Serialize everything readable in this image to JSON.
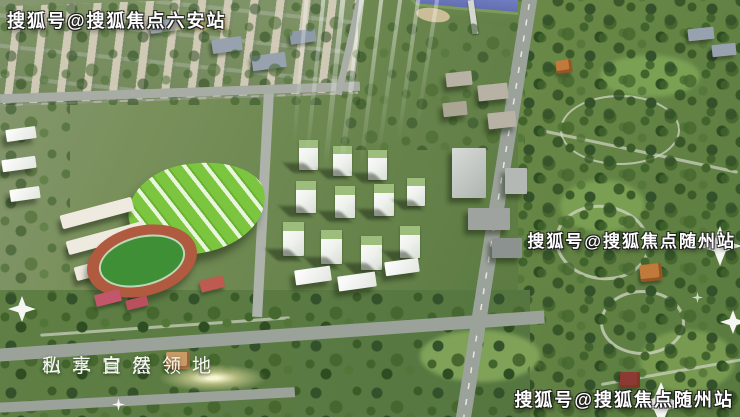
{
  "watermarks": {
    "top_left": "搜狐号@搜狐焦点六安站",
    "middle_right": "搜狐号@搜狐焦点随州站",
    "bottom_right": "搜狐号@搜狐焦点随州站",
    "developer_logo_faint": "江城投"
  },
  "slogan": {
    "part1": "山水宜居",
    "part2": "私享自然领地"
  },
  "colors": {
    "park_green": "#5e7d44",
    "tree_dark_green": "#33512a",
    "river_blue": "#7d88c6",
    "school_roof_green": "#7cc63f",
    "track_red": "#b05a40",
    "field_green": "#3e8f35",
    "tower_white": "#eef1ec",
    "road_gray": "#9ba29a",
    "watermark_white": "#ffffff",
    "developer_logo_yellow": "#d8b84a"
  }
}
